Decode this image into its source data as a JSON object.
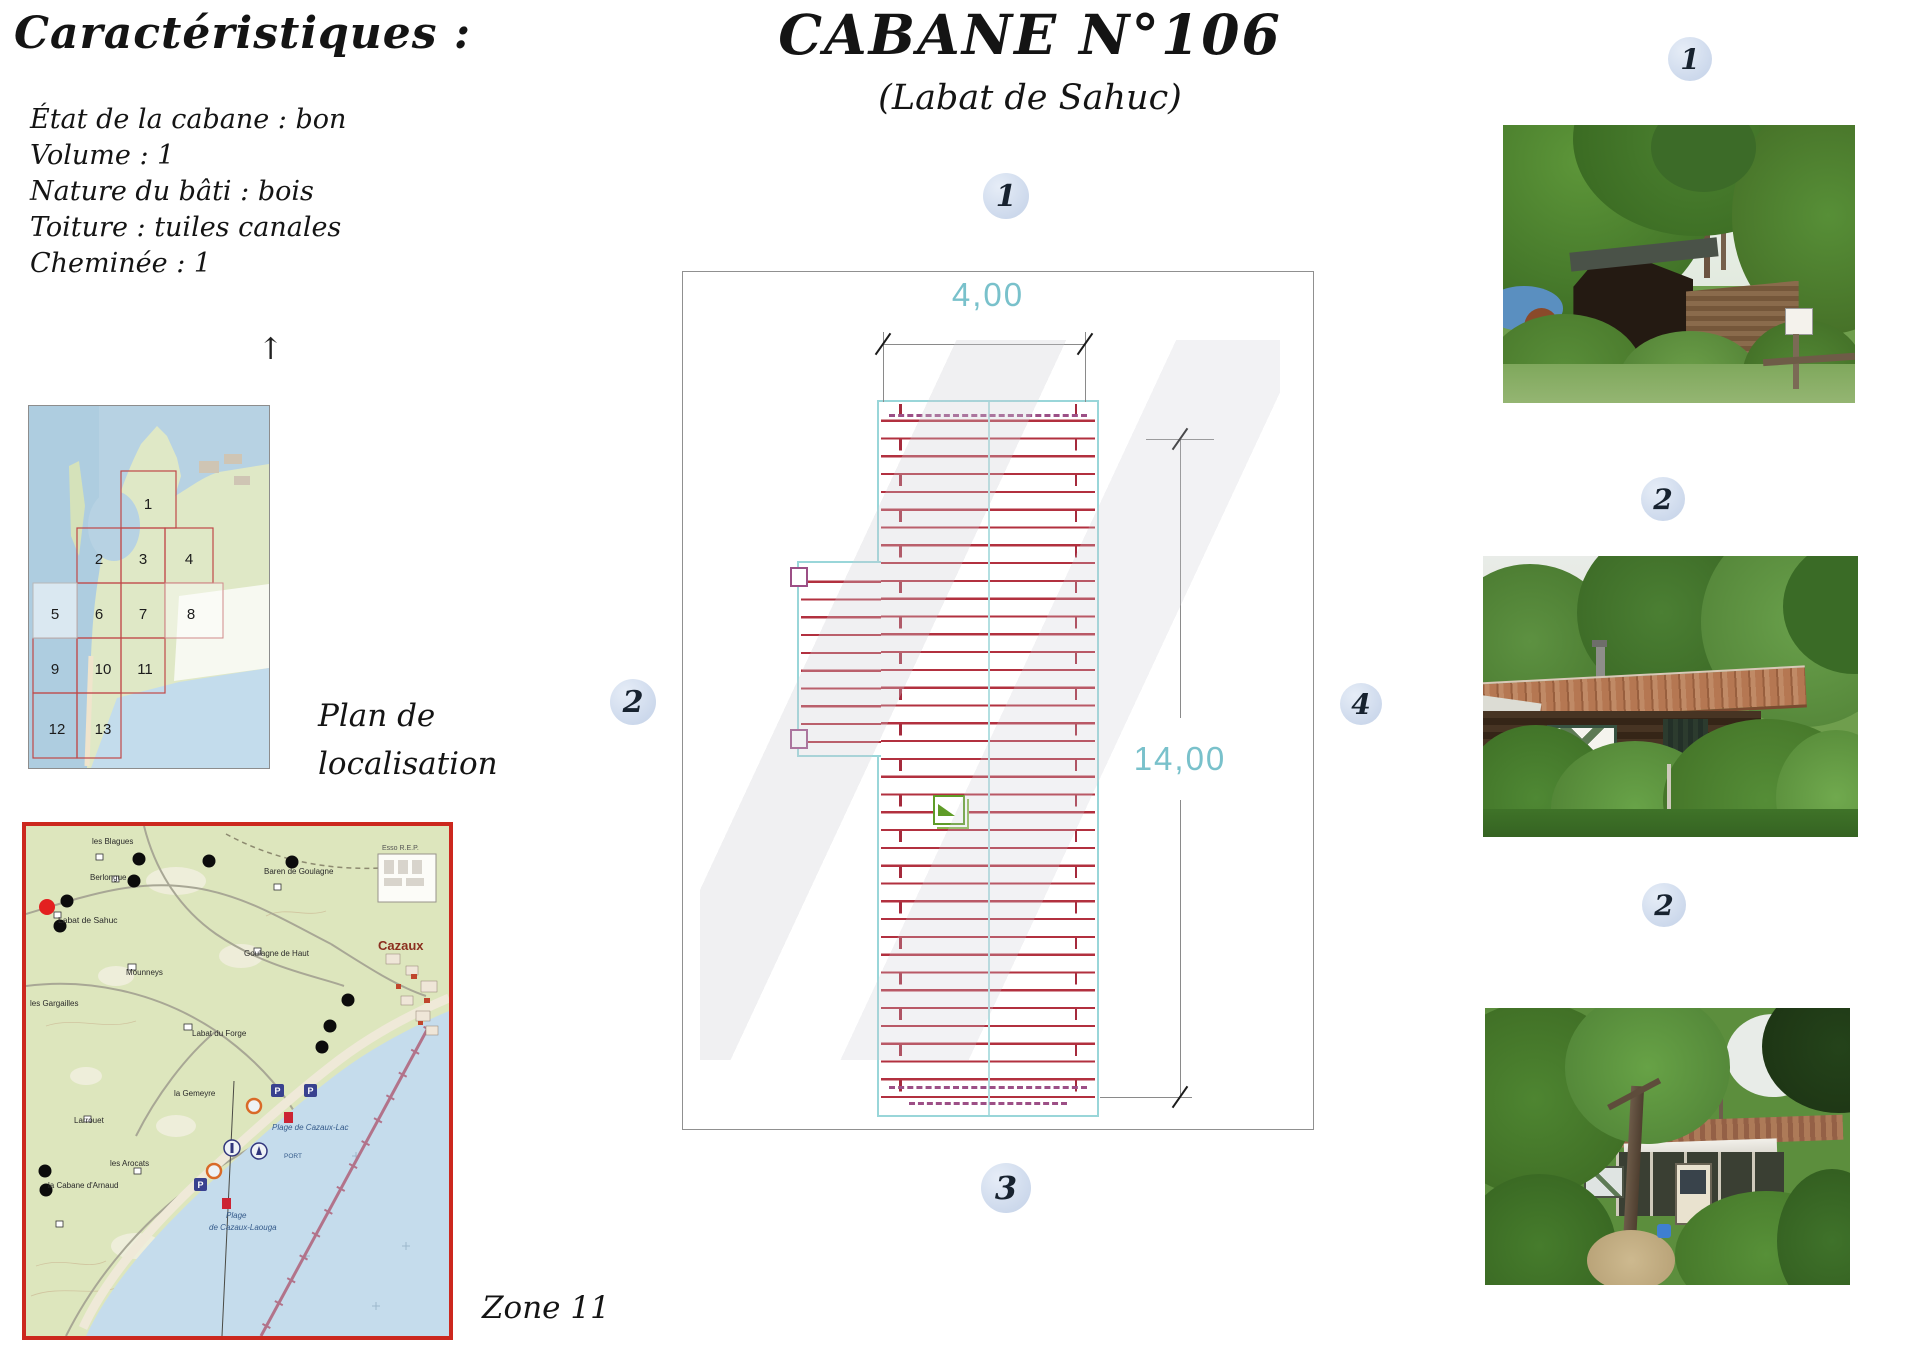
{
  "page": {
    "title": "CABANE N°106",
    "subtitle": "(Labat de Sahuc)"
  },
  "characteristics": {
    "heading": "Caractéristiques :",
    "items": [
      "État de la cabane : bon",
      "Volume : 1",
      "Nature du bâti : bois",
      "Toiture : tuiles canales",
      "Cheminée : 1"
    ]
  },
  "location_map": {
    "caption_line1": "Plan de",
    "caption_line2": "localisation",
    "north_arrow": "↑",
    "grid_numbers": [
      "1",
      "2",
      "3",
      "4",
      "5",
      "6",
      "7",
      "8",
      "9",
      "10",
      "11",
      "12",
      "13"
    ]
  },
  "zone_map": {
    "zone_label": "Zone 11",
    "place_labels": {
      "blagues": "les Blagues",
      "berlongue": "Berlongue",
      "labat_sahuc": "Labat de Sahuc",
      "baren_goulagne": "Baren de Goulagne",
      "mounneys": "Mounneys",
      "goulagne_haut": "Goulagne de Haut",
      "esso": "Esso R.E.P.",
      "cazaux": "Cazaux",
      "gargailles": "les Gargailles",
      "labat_forge": "Labat du Forge",
      "gemeyre": "la Gemeyre",
      "larrouet": "Larrouet",
      "arocats": "les Arocats",
      "cabane_arnaud": "la Cabane d'Arnaud",
      "plage_lac": "Plage de Cazaux-Lac",
      "port": "PORT",
      "plage_laouga_1": "Plage",
      "plage_laouga_2": "de Cazaux-Laouga",
      "parking": "P"
    }
  },
  "plan": {
    "width_dim": "4,00",
    "height_dim": "14,00",
    "markers": {
      "m1": "1",
      "m2": "2",
      "m3": "3",
      "m4": "4"
    }
  },
  "photos": {
    "badge1": "1",
    "badge2": "2",
    "badge3": "2"
  },
  "colors": {
    "dimension_text": "#79c1cb",
    "plan_outline": "#99d6d9",
    "plan_hatch": "#b2303f",
    "dashed_accent": "#9c4f86",
    "marker_fill": "#cfdcee",
    "zone_map_border": "#cc281e",
    "green_symbol": "#5f9c28",
    "location_dot": "#e32020"
  }
}
